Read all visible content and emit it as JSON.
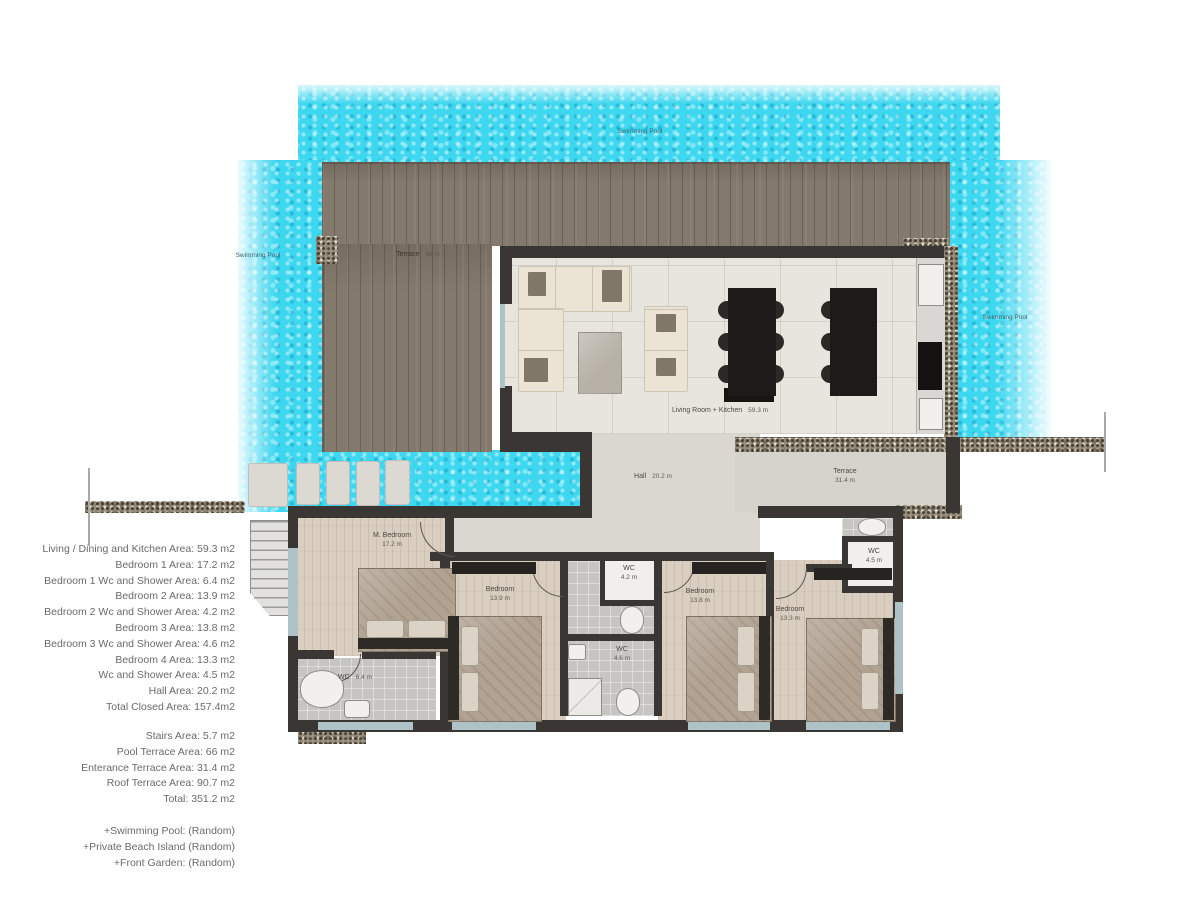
{
  "pool_labels": {
    "top": "Swimming Pool",
    "left": "Swimming Pool",
    "right": "Swimming Pool"
  },
  "rooms": {
    "pool_terrace": {
      "name": "Terrace",
      "area": "66 m"
    },
    "living": {
      "name": "Living Room + Kitchen",
      "area": "59.3 m"
    },
    "hall": {
      "name": "Hall",
      "area": "20.2 m"
    },
    "front_terrace": {
      "name": "Terrace",
      "area": "31.4 m"
    },
    "master": {
      "name": "M. Bedroom",
      "area": "17.2 m"
    },
    "bedroom2": {
      "name": "Bedroom",
      "area": "13.9 m"
    },
    "bedroom3": {
      "name": "Bedroom",
      "area": "13.8 m"
    },
    "bedroom4": {
      "name": "Bedroom",
      "area": "13.3 m"
    },
    "wc_master": {
      "name": "WC",
      "area": "6.4 m"
    },
    "wc_small": {
      "name": "WC",
      "area": "4.2 m"
    },
    "wc_mid": {
      "name": "WC",
      "area": "4.6 m"
    },
    "wc_right": {
      "name": "WC",
      "area": "4.5 m"
    }
  },
  "legend": {
    "closed_areas": [
      "Living / Dining and Kitchen Area: 59.3 m2",
      "Bedroom 1 Area: 17.2 m2",
      "Bedroom 1 Wc and Shower Area: 6.4 m2",
      "Bedroom 2 Area: 13.9 m2",
      "Bedroom 2 Wc and Shower Area: 4.2 m2",
      "Bedroom 3 Area: 13.8 m2",
      "Bedroom 3 Wc and Shower Area: 4.6 m2",
      "Bedroom 4 Area: 13.3 m2",
      "Wc and Shower Area: 4.5 m2",
      "Hall Area: 20.2 m2",
      "Total Closed Area: 157.4m2"
    ],
    "open_areas": [
      "Stairs Area: 5.7 m2",
      "Pool Terrace Area: 66 m2",
      "Enterance Terrace Area: 31.4 m2",
      "Roof Terrace Area: 90.7 m2",
      "Total: 351.2 m2"
    ],
    "extras": [
      "+Swimming Pool: (Random)",
      "+Private Beach Island (Random)",
      "+Front Garden: (Random)"
    ]
  },
  "colors": {
    "pool": "#3dd7f0",
    "deck": "#83796d",
    "wall": "#3a3633",
    "window": "#aec3c8"
  }
}
